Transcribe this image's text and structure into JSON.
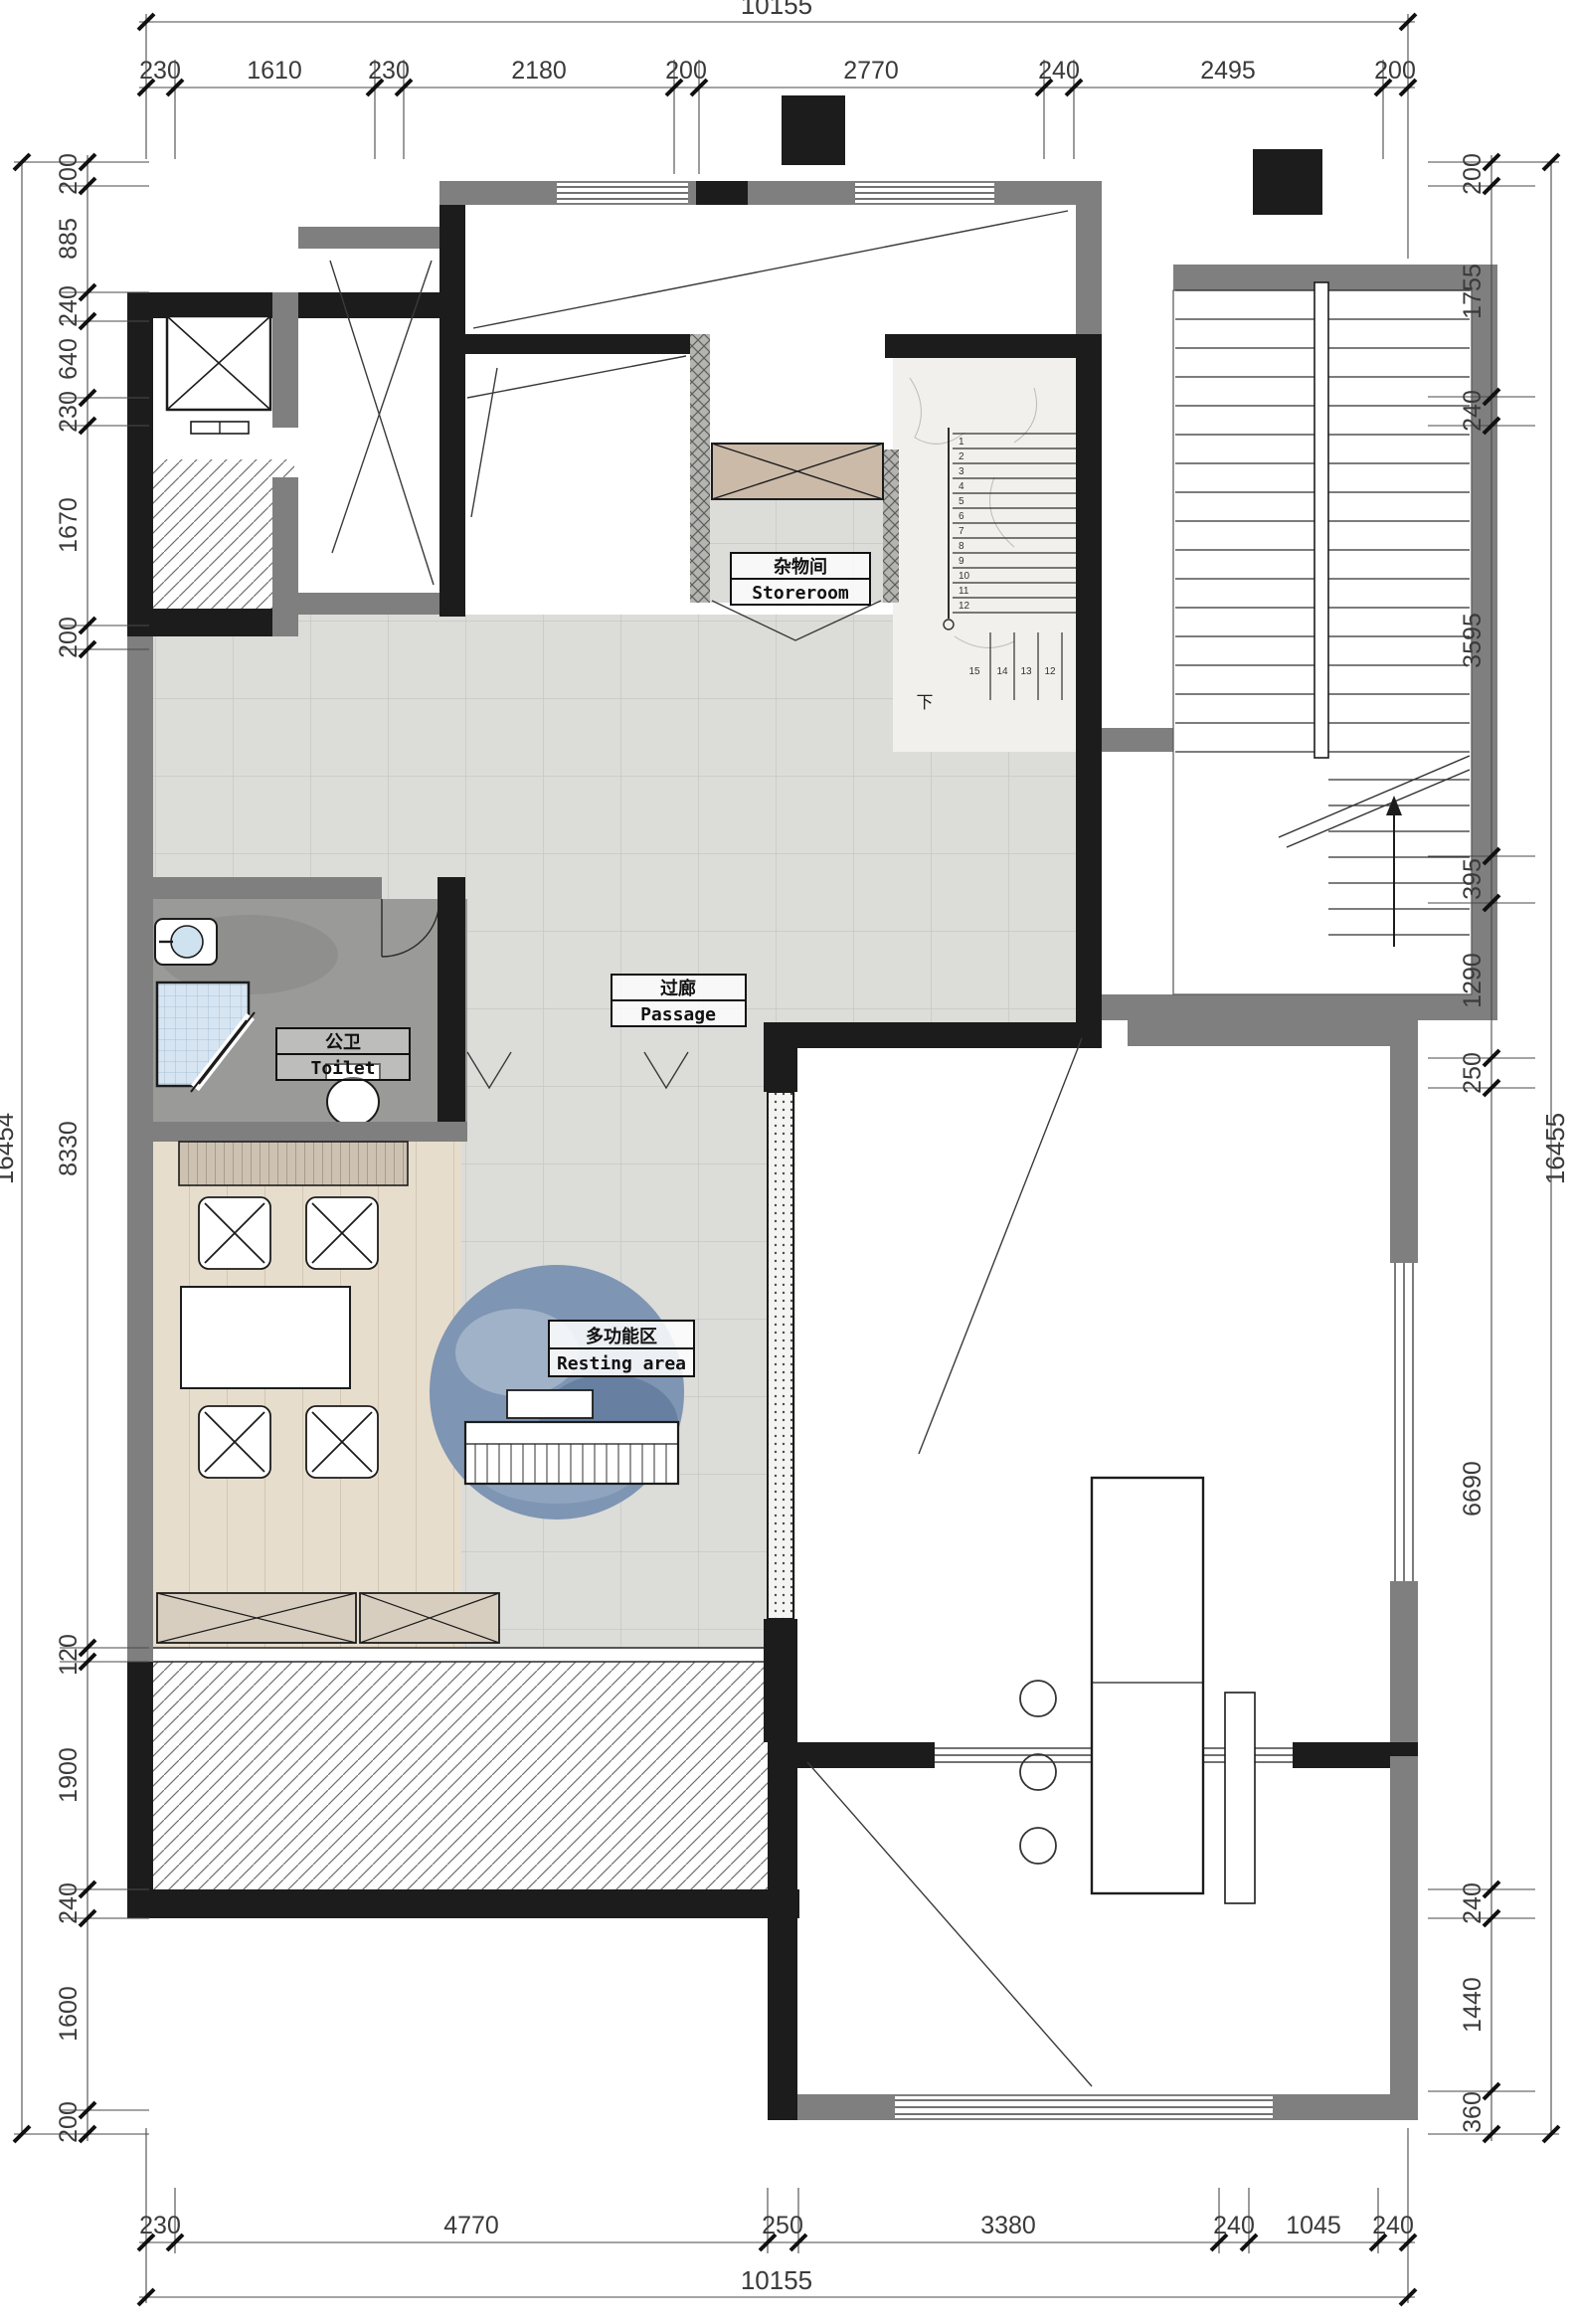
{
  "drawing": {
    "type": "residential floor plan",
    "language": "zh/en"
  },
  "dims": {
    "top": {
      "total": "10155",
      "segments": [
        "230",
        "1610",
        "230",
        "2180",
        "200",
        "2770",
        "240",
        "2495",
        "200"
      ]
    },
    "bottom": {
      "total": "10155",
      "segments": [
        "230",
        "4770",
        "250",
        "3380",
        "240",
        "1045",
        "240"
      ]
    },
    "left": {
      "total": "16454",
      "segments": [
        "200",
        "885",
        "240",
        "640",
        "230",
        "1670",
        "200",
        "8330",
        "120",
        "1900",
        "240",
        "1600",
        "200"
      ]
    },
    "right": {
      "total": "16455",
      "segments": [
        "200",
        "1755",
        "240",
        "3595",
        "395",
        "1290",
        "250",
        "6690",
        "240",
        "1440",
        "360"
      ]
    }
  },
  "rooms": {
    "storeroom": {
      "zh": "杂物间",
      "en": "Storeroom"
    },
    "passage": {
      "zh": "过廊",
      "en": "Passage"
    },
    "toilet": {
      "zh": "公卫",
      "en": "Toilet"
    },
    "resting": {
      "zh": "多功能区",
      "en": "Resting area"
    }
  },
  "stairs": {
    "down_marker": "下",
    "upper_run_numbers": [
      "1",
      "2",
      "3",
      "4",
      "5",
      "6",
      "7",
      "8",
      "9",
      "10",
      "11",
      "12"
    ],
    "lower_run_numbers": [
      "15",
      "14",
      "13",
      "12"
    ]
  },
  "colors": {
    "wall_black": "#1c1c1c",
    "wall_grey": "#7f7f7f",
    "tile_floor": "#dcdcd9",
    "toilet_floor": "#9a9a98",
    "wood_floor": "#e7ddcc",
    "cabinet_tan": "#cbbaa8",
    "rug_blue": "#7e95b3",
    "shower_blue": "#d6e4f1",
    "stair_marble": "#f1f0ec"
  }
}
